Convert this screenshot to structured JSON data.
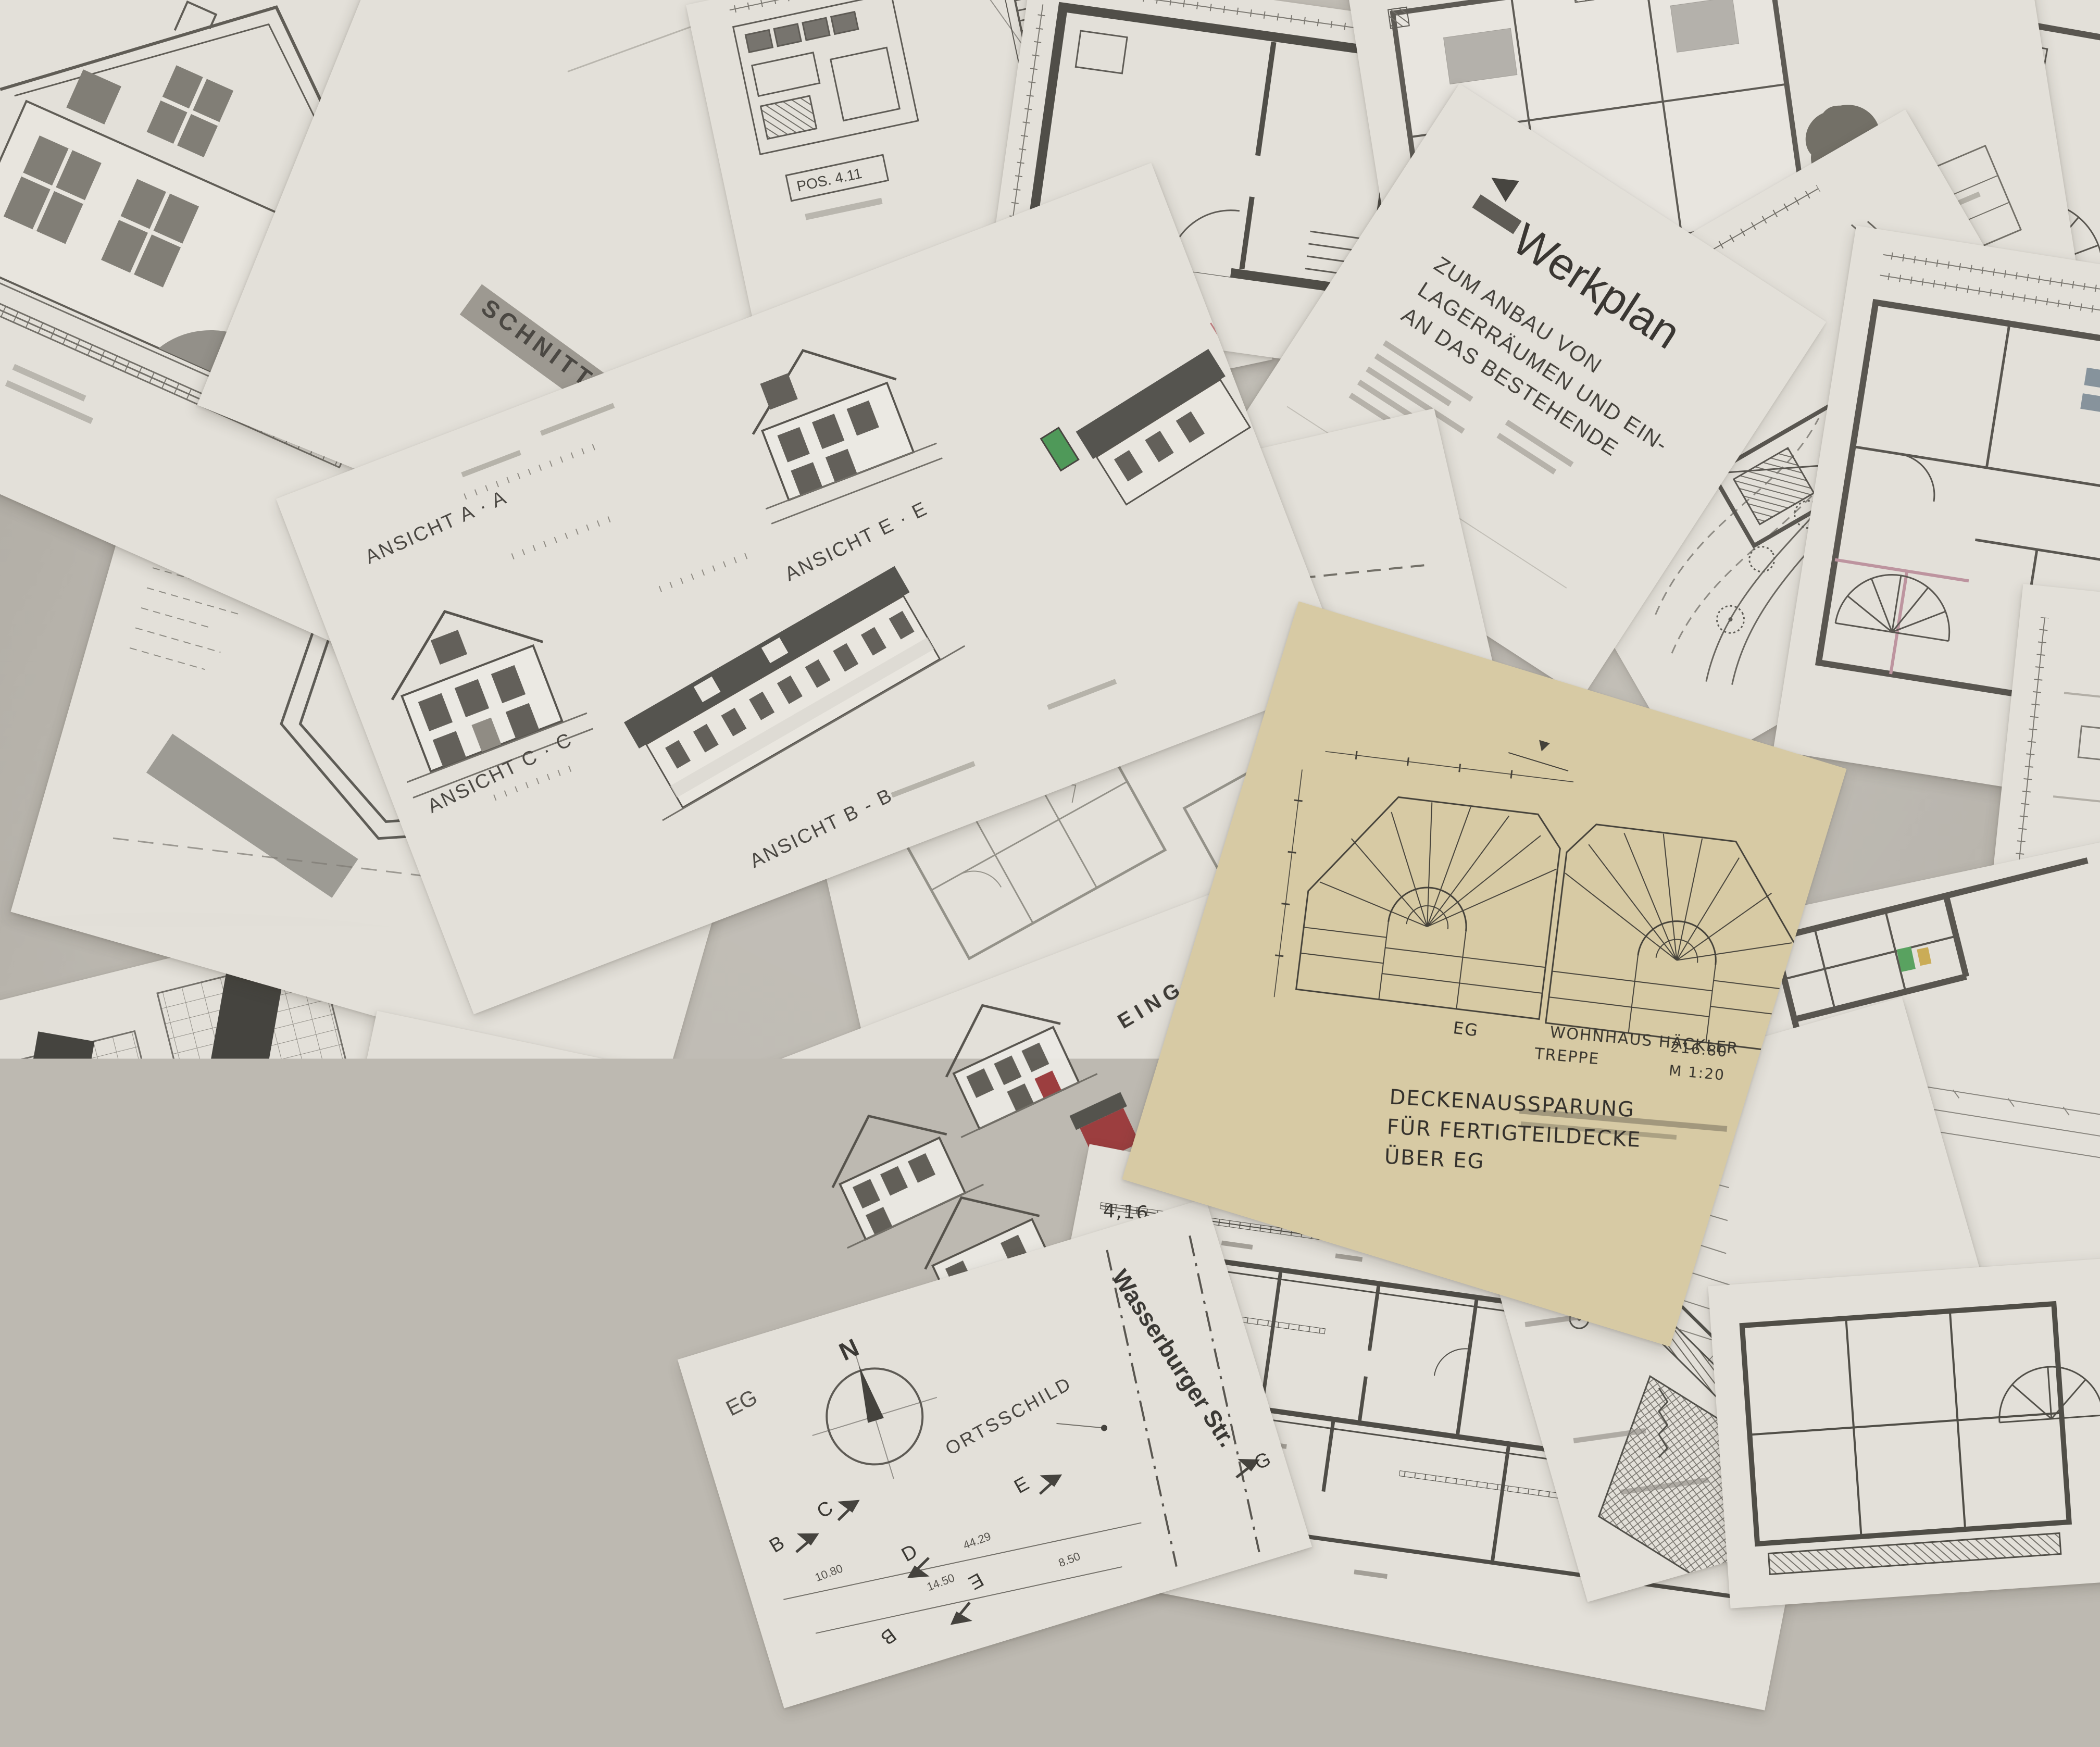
{
  "scene": {
    "background": "#bdb9b1",
    "paper": "#e3e0d9",
    "paper_tracing_yellow": "#d7caa4",
    "ink": "#4d4a44",
    "ink_dark": "#2f2e2b",
    "accent_red": "#9c3a38",
    "accent_green": "#449450",
    "accent_blue": "#5f87a8",
    "accent_pink": "#b98f9b",
    "accent_yellow": "#c9a94e"
  },
  "ansicht_sheet": {
    "label_aa": "ANSICHT A · A",
    "label_ee": "ANSICHT E · E",
    "label_cc": "ANSICHT C · C",
    "label_bb": "ANSICHT B - B"
  },
  "schnitt_sheet": {
    "title": "SCHNITT"
  },
  "werkplan_sheet": {
    "title": "Werkplan",
    "line1": "ZUM ANBAU VON",
    "line2": "LAGERRÄUMEN UND EIN-",
    "line3": "AN DAS BESTEHENDE"
  },
  "vorabzug_sheet": {
    "stamp": "VORABZUG"
  },
  "eingabeplan_sheet": {
    "title": "EINGABEPLAN",
    "subtitle": "Errichtung eines Einfamilienhauses"
  },
  "siteplan_sheet": {
    "north_label": "N",
    "ortsschild": "ORTSSCHILD",
    "street": "Wasserburger Str.",
    "floor_label": "EG",
    "marker_b": "B",
    "marker_c": "C",
    "marker_d": "D",
    "marker_e": "E",
    "marker_g": "G",
    "dim_total": "44.29",
    "dim_a": "10.80",
    "dim_b": "14.50",
    "dim_c": "8.50"
  },
  "treppe_sheet": {
    "floor_label": "EG",
    "note_line1": "DECKENAUSSPARUNG",
    "note_line2": "FÜR FERTIGTEILDECKE",
    "note_line3": "ÜBER EG",
    "project": "WOHNHAUS HÄCKLER",
    "part": "TREPPE",
    "level": "216.80",
    "scale": "M 1:20",
    "architect": "ARCHITEKT WOLFGANG TRAIDL"
  },
  "kg_sheet": {
    "label": "KG"
  },
  "stairdetail_sheet": {
    "pos_label": "POS. 4.11"
  },
  "colorcad_sheet": {
    "room_kueche": "Küche",
    "room_essen": "Essen",
    "room_wohnen": "Wohnen",
    "room_wc": "WC",
    "marker_a": "A"
  },
  "leftplans_sheet": {
    "marker_b": "B"
  },
  "handplan_sheet": {
    "dim_total": "4,16"
  }
}
